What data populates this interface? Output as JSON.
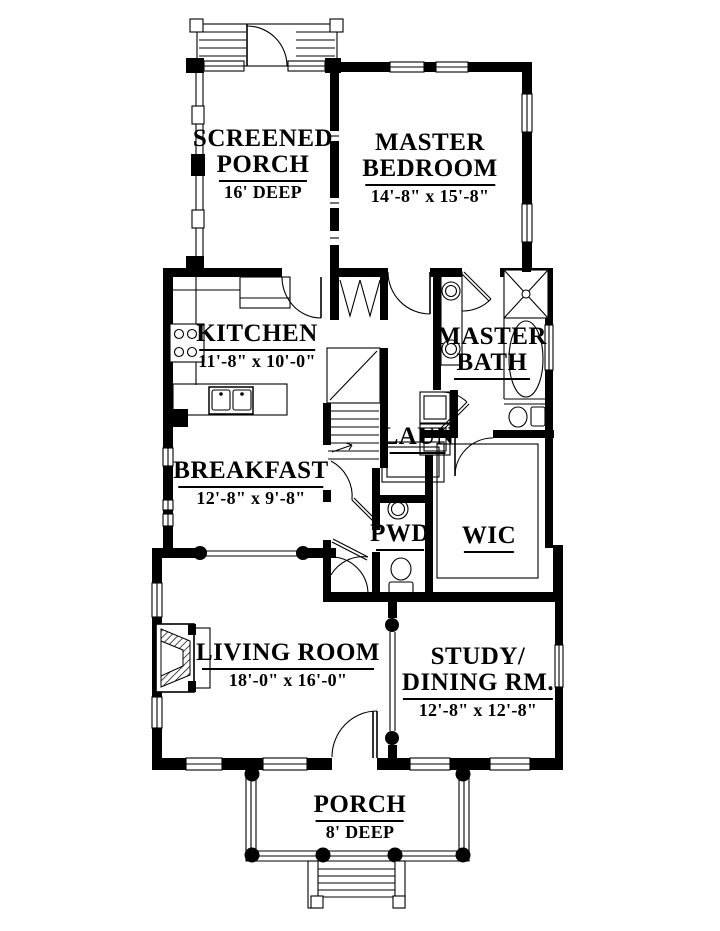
{
  "title": "First floor plan",
  "colors": {
    "ink": "#000000",
    "paper": "#ffffff"
  },
  "rooms": {
    "screened_porch": {
      "line1": "SCREENED",
      "line2": "PORCH",
      "dim": "16' DEEP"
    },
    "master_bedroom": {
      "line1": "MASTER",
      "line2": "BEDROOM",
      "dim": "14'-8\" x 15'-8\""
    },
    "kitchen": {
      "line1": "KITCHEN",
      "dim": "11'-8\" x 10'-0\""
    },
    "master_bath": {
      "line1": "MASTER",
      "line2": "BATH"
    },
    "laundry": {
      "line1": "LAUN"
    },
    "breakfast": {
      "line1": "BREAKFAST",
      "dim": "12'-8\" x 9'-8\""
    },
    "powder": {
      "line1": "PWD"
    },
    "wic": {
      "line1": "WIC"
    },
    "living_room": {
      "line1": "LIVING ROOM",
      "dim": "18'-0\" x 16'-0\""
    },
    "study_dining": {
      "line1": "STUDY/",
      "line2": "DINING RM.",
      "dim": "12'-8\" x 12'-8\""
    },
    "porch": {
      "line1": "PORCH",
      "dim": "8' DEEP"
    }
  }
}
